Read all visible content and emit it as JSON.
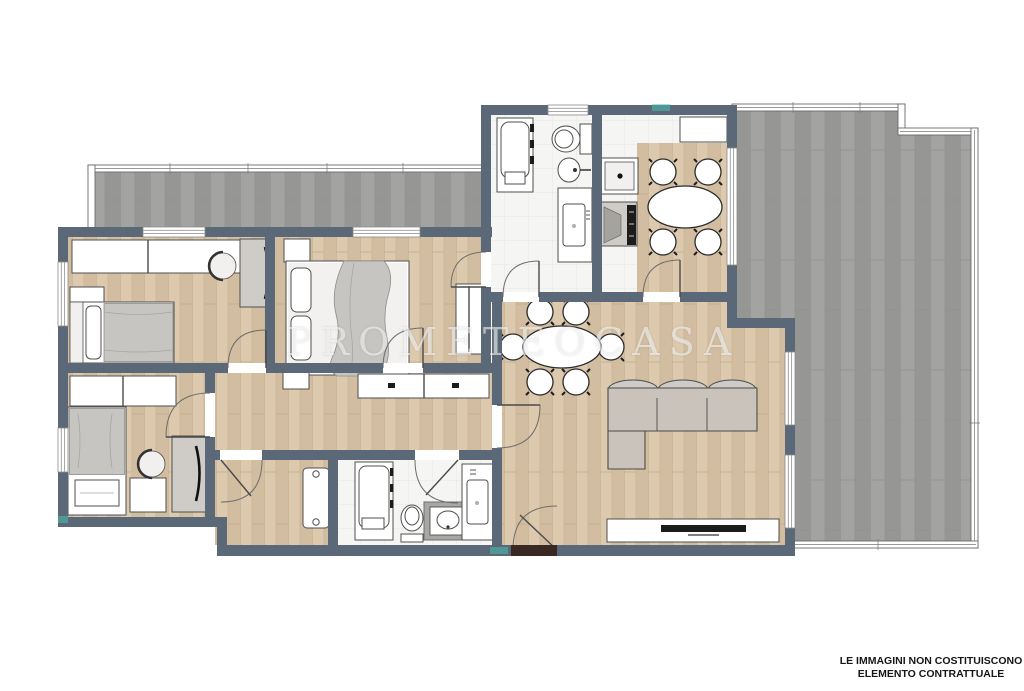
{
  "page": {
    "background": "#ffffff"
  },
  "watermark": {
    "text": "PROMETEOCASA"
  },
  "disclaimer": {
    "line1": "LE IMMAGINI NON COSTITUISCONO",
    "line2": "ELEMENTO CONTRATTUALE"
  },
  "colors": {
    "page_bg": "#ffffff",
    "wall": "#5b6877",
    "wood_floor": "#d6c2a6",
    "terrace_deck": "#9c9c9a",
    "bathroom_tile": "#f5f5f3",
    "furniture_gray": "#cfccc8",
    "entrance_door": "#3a2822",
    "accent_teal": "#49c6b6",
    "disclaimer_text": "#161616"
  }
}
